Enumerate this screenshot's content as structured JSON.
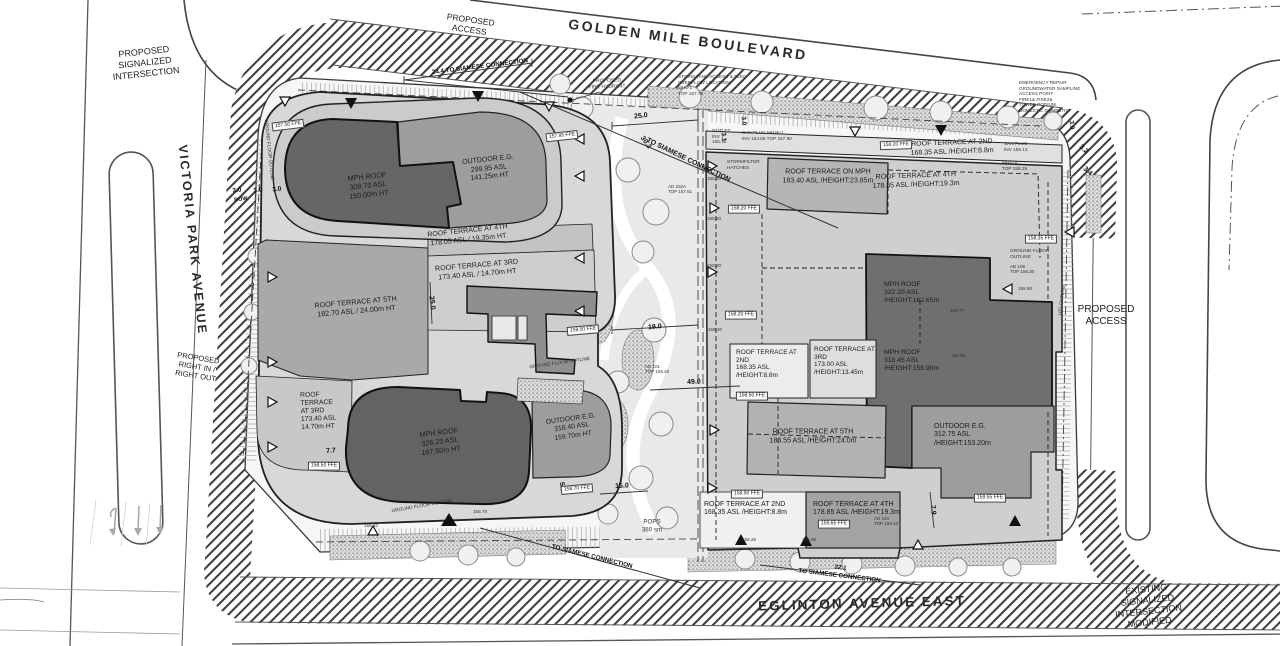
{
  "streets": {
    "golden_mile": "GOLDEN MILE BOULEVARD",
    "victoria_park": "VICTORIA PARK AVENUE",
    "eglinton": "EGLINTON AVENUE EAST"
  },
  "corner_labels": {
    "nw": "PROPOSED\nSIGNALIZED\nINTERSECTION",
    "se": "EXISTING\nSIGNALIZED\nINTERSECTION\nMODIFIED",
    "right_in_out": "PROPOSED\nRIGHT IN /\nRIGHT OUT",
    "access_top": "PROPOSED\nACCESS",
    "access_right": "PROPOSED\nACCESS"
  },
  "west_building": {
    "mph_roof_upper": "MPH ROOF\n308.70 ASL\n150.00m HT",
    "outdoor_eg_upper": "OUTDOOR E.G.\n299.95 ASL\n141.25m HT",
    "terrace_4th": "ROOF TERRACE AT 4TH\n178.05 ASL / 19.35m HT",
    "terrace_3rd": "ROOF TERRACE AT 3RD\n173.40 ASL / 14.70m HT",
    "terrace_5th": "ROOF TERRACE AT 5TH\n182.70 ASL / 24.00m HT",
    "terrace_3rd_left": "ROOF\nTERRACE\nAT 3RD\n173.40 ASL\n14.70m HT",
    "mph_roof_lower": "MPH ROOF\n326.20 ASL\n167.50m HT",
    "outdoor_eg_lower": "OUTDOOR E.G.\n318.40 ASL\n159.70m HT"
  },
  "east_building": {
    "terrace_2nd_top": "ROOF TERRACE AT 2ND\n168.35 ASL /HEIGHT:8.8m",
    "terrace_on_mph": "ROOF TERRACE ON MPH\n183.40 ASL /HEIGHT:23.85m",
    "terrace_4th_top": "ROOF TERRACE AT 4TH\n178.85 ASL /HEIGHT:19.3m",
    "mph_roof_a": "MPH ROOF\n322.20 ASL\n/HEIGHT:162.65m",
    "mph_roof_b": "MPH ROOF\n318.45 ASL\n/HEIGHT:158.90m",
    "terrace_2nd_mid": "ROOF TERRACE AT\n2ND\n168.35 ASL\n/HEIGHT:8.8m",
    "terrace_3rd_mid": "ROOF TERRACE AT\n3RD\n173.00 ASL\n/HEIGHT:13.45m",
    "terrace_5th": "ROOF TERRACE AT 5TH\n183.55 ASL /HEIGHT:24.0m",
    "outdoor_eg": "OUTDOOR E.G.\n312.75 ASL\n/HEIGHT:153.20m",
    "terrace_2nd_bottom": "ROOF TERRACE AT 2ND\n168.35 ASL /HEIGHT:8.8m",
    "terrace_4th_bottom": "ROOF TERRACE AT 4TH\n178.85 ASL /HEIGHT:19.3m"
  },
  "dimensions": {
    "siamese_top": "24.4 TO SIAMESE CONNECTION",
    "siamese_center": "TO SIAMESE CONNECTION",
    "siamese_bottom_left": "TO SIAMESE CONNECTION",
    "siamese_bottom_right": "32.1\nTO SIAMESE CONNECTION",
    "d_25": "25.0",
    "d_30_2": "30.2",
    "d_19": "19.0",
    "d_49": "49.0",
    "d_15": "15.0",
    "d_25_v": "25.0",
    "d_7_7": "7.7",
    "d_7_9": "7.9",
    "d_5_0": "5.0",
    "d_3_2": "3.2",
    "d_3_4": "3.4",
    "d_3_1": "3.1",
    "d_3_0_a": "3.0",
    "d_3_0_b": "3.0",
    "d_3_0_c": "3.0",
    "d_3_0_d": "3.0",
    "d_3_0_e": "3.0",
    "row": "ROW"
  },
  "ffe_badges": [
    "157.50 FFE",
    "157.95 FFE",
    "158.20 FFE",
    "158.20 FFE",
    "158.20 FFE",
    "158.50 FFE",
    "158.50 FFE",
    "158.50 FFE",
    "158.70 FFE",
    "158.35 FFE",
    "158.90 FFE",
    "159.55 FFE",
    "159.65 FFE"
  ],
  "spot_elevations": [
    "158.20",
    "158.20",
    "158.20",
    "158.20",
    "158.60",
    "158.77",
    "158.95",
    "158.40",
    "158.70",
    "158.26",
    "158.95"
  ],
  "utilities": {
    "fire_hydrant": "PROPOSED\nFIRE HYDRANT",
    "storm_tank": "STORM TANK ACCESS & ELEC\nOVERFLOW LOCATION\nMH6-1\nTOP 157.79",
    "san_plug_west": "SAN PLUG   MH46-1\nINV 154.66   TOP 157.90",
    "stormfilter": "STORMFILTER\nHATCHES",
    "outlet": "OUTLET\nINV\n155.35",
    "san_plug_east": "SAN PLUG\nINV 155.13",
    "mh47a": "MH47A\nTOP 158.15",
    "emergency": "EMERGENCY REPAIR\nGROUNDWATER SAMPLING\nACCESS POINT\nFIRE1&   FIRE2&\nTOWER   PODIUM\nDOMESTIC DOMESTIC",
    "ground_floor_outline": "GROUND FLOOR OUTLINE",
    "ground_floor_outline_2l": "GROUND FLOOR\nOUTLINE",
    "ug_outline": "U/G OUTLINE",
    "ad_202a": "AD 202A\nTOP 157.61",
    "ad_101": "AD 101\nTOP 158.20",
    "ad_104": "AD 104\nTOP 159.43",
    "ad_106": "AD 106\nTOP 158.30",
    "pops": "POPS\n380 sm"
  },
  "colors": {
    "roof_dark": "#666666",
    "roof_medium": "#9d9d9d",
    "terrace_medium": "#a9a9a9",
    "podium_light": "#d8d8d8",
    "line": "#1a1a1a"
  }
}
